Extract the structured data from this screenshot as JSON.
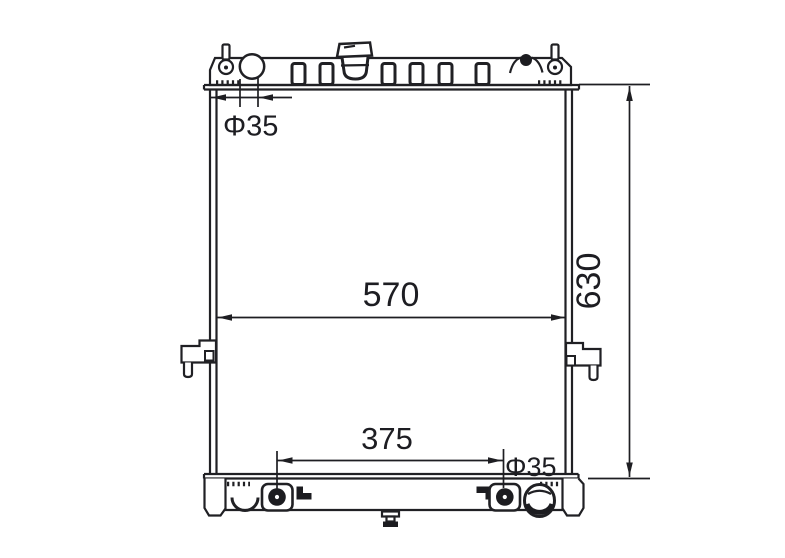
{
  "page": {
    "background": "#ffffff"
  },
  "colors": {
    "line": "#202024",
    "dimension_text": "#1d1d22"
  },
  "drawing": {
    "labels": {
      "inlet_diameter": "Φ35",
      "core_width": "570",
      "overall_height": "630",
      "mounting_pin_spacing": "375",
      "outlet_diameter": "Φ35"
    }
  }
}
